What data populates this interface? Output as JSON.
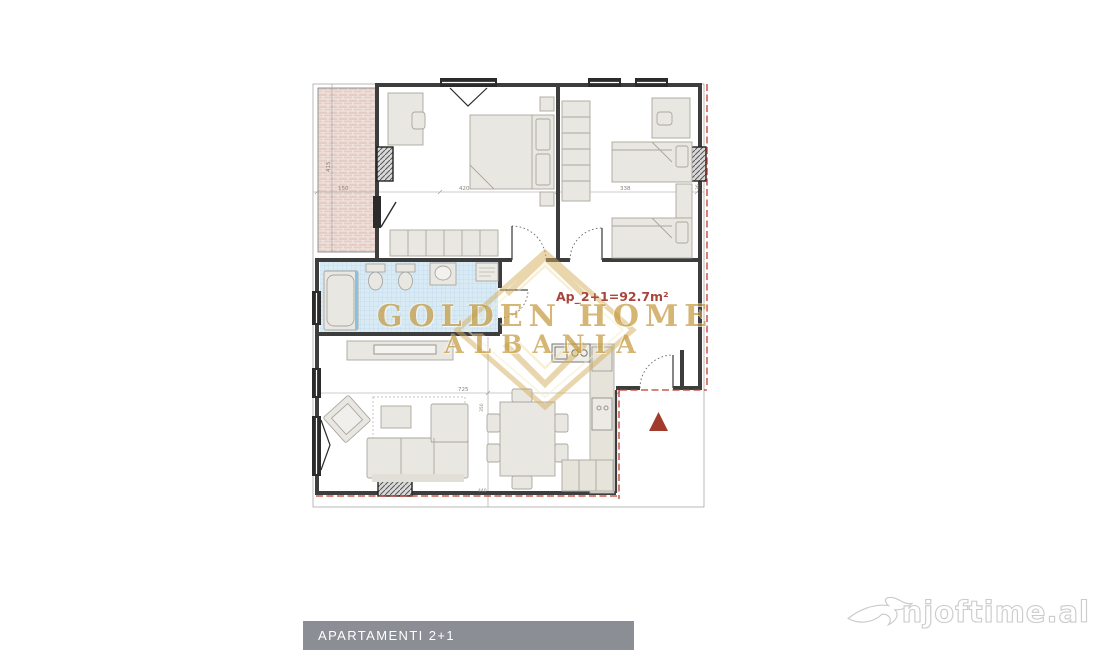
{
  "floor_plan": {
    "area_label": "Ap_2+1=92.7m²",
    "dimensions": {
      "balcony_width": "150",
      "bedroom1_width": "420",
      "bedroom2_width": "338",
      "right_side": "36",
      "balcony_height": "415",
      "living_width": "725",
      "living_height": "350",
      "bottom_width": "440"
    },
    "watermark": {
      "line1": "GOLDEN HOME",
      "line2": "ALBANIA"
    },
    "colors": {
      "accent_gold": "#C59A3F",
      "area_label_red": "#A8453C",
      "marker_red": "#A33B2C",
      "boundary_dashed_red": "#BF3A2B",
      "banner_gray": "#8B8E94",
      "bathroom_tile_blue": "#D8EAF4",
      "balcony_brick_pink": "#E5CDC5",
      "wall_dark": "#3D3D3D"
    }
  },
  "banner": {
    "label": "APARTAMENTI 2+1"
  },
  "brand": {
    "name": "njoftime.al"
  }
}
